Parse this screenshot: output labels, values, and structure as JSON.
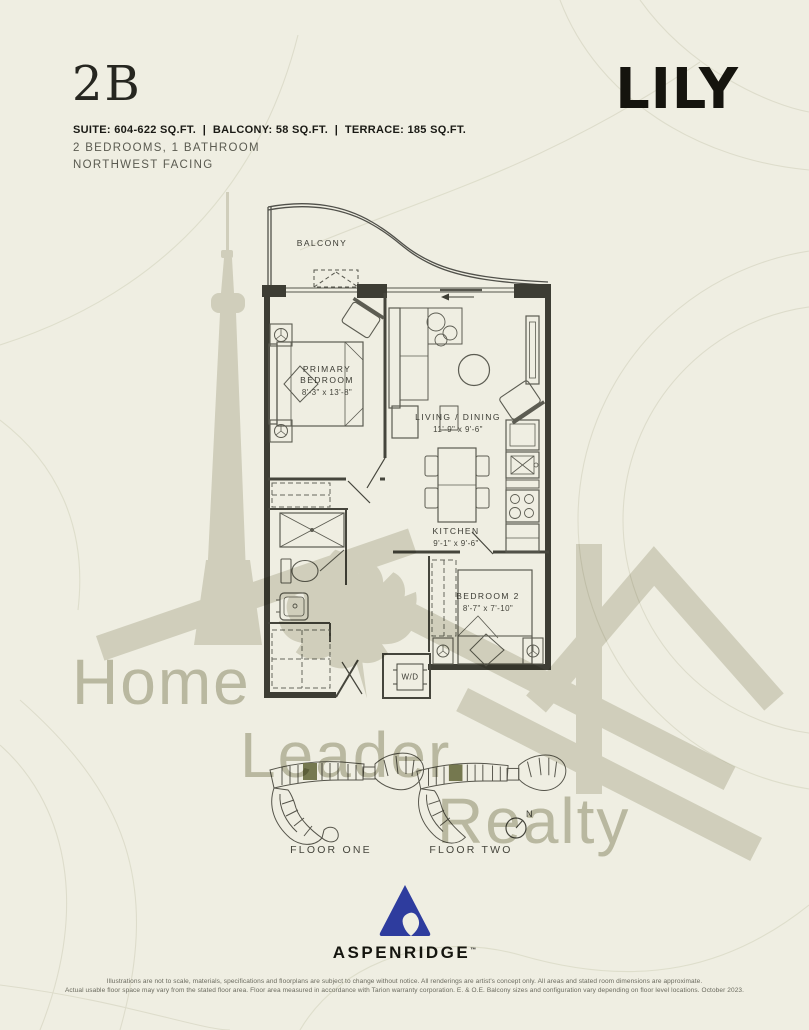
{
  "header": {
    "unit_code": "2B",
    "brand": "LILY",
    "specs": "SUITE: 604-622 SQ.FT.  |  BALCONY: 58 SQ.FT.  |  TERRACE: 185 SQ.FT.",
    "config": "2 BEDROOMS, 1 BATHROOM",
    "facing": "NORTHWEST FACING"
  },
  "floorplan": {
    "balcony_label": "BALCONY",
    "primary_bedroom": {
      "name": "PRIMARY BEDROOM",
      "dims": "8'-3\" x 13'-8\""
    },
    "living_dining": {
      "name": "LIVING / DINING",
      "dims": "11'-9\" x 9'-6\""
    },
    "kitchen": {
      "name": "KITCHEN",
      "dims": "9'-1\" x 9'-6\""
    },
    "bedroom_2": {
      "name": "BEDROOM 2",
      "dims": "8'-7\" x 7'-10\""
    },
    "laundry_label": "W/D"
  },
  "keyplans": {
    "floor_one_label": "FLOOR ONE",
    "floor_two_label": "FLOOR TWO",
    "compass_label": "N"
  },
  "watermark": {
    "word_1": "Home",
    "word_2": "Leader",
    "word_3": "Realty"
  },
  "footer": {
    "developer_name": "ASPENRIDGE",
    "trademark": "™",
    "disclaimer_line_1": "Illustrations are not to scale, materials, specifications and floorplans are subject to change without notice. All renderings are artist's concept only. All areas and stated room dimensions are approximate.",
    "disclaimer_line_2": "Actual usable floor space may vary from the stated floor area. Floor area measured in accordance with Tarion warranty corporation. E. & O.E. Balcony sizes and configuration vary depending on floor level locations. October 2023."
  },
  "colors": {
    "background": "#efeee2",
    "ink": "#1f1f19",
    "plan_line": "#3d3d34",
    "muted_text": "#5d5d52",
    "watermark_gray": "#c8c7b6",
    "developer_blue": "#2e3c9e",
    "keyplan_highlight": "#6e7147"
  }
}
